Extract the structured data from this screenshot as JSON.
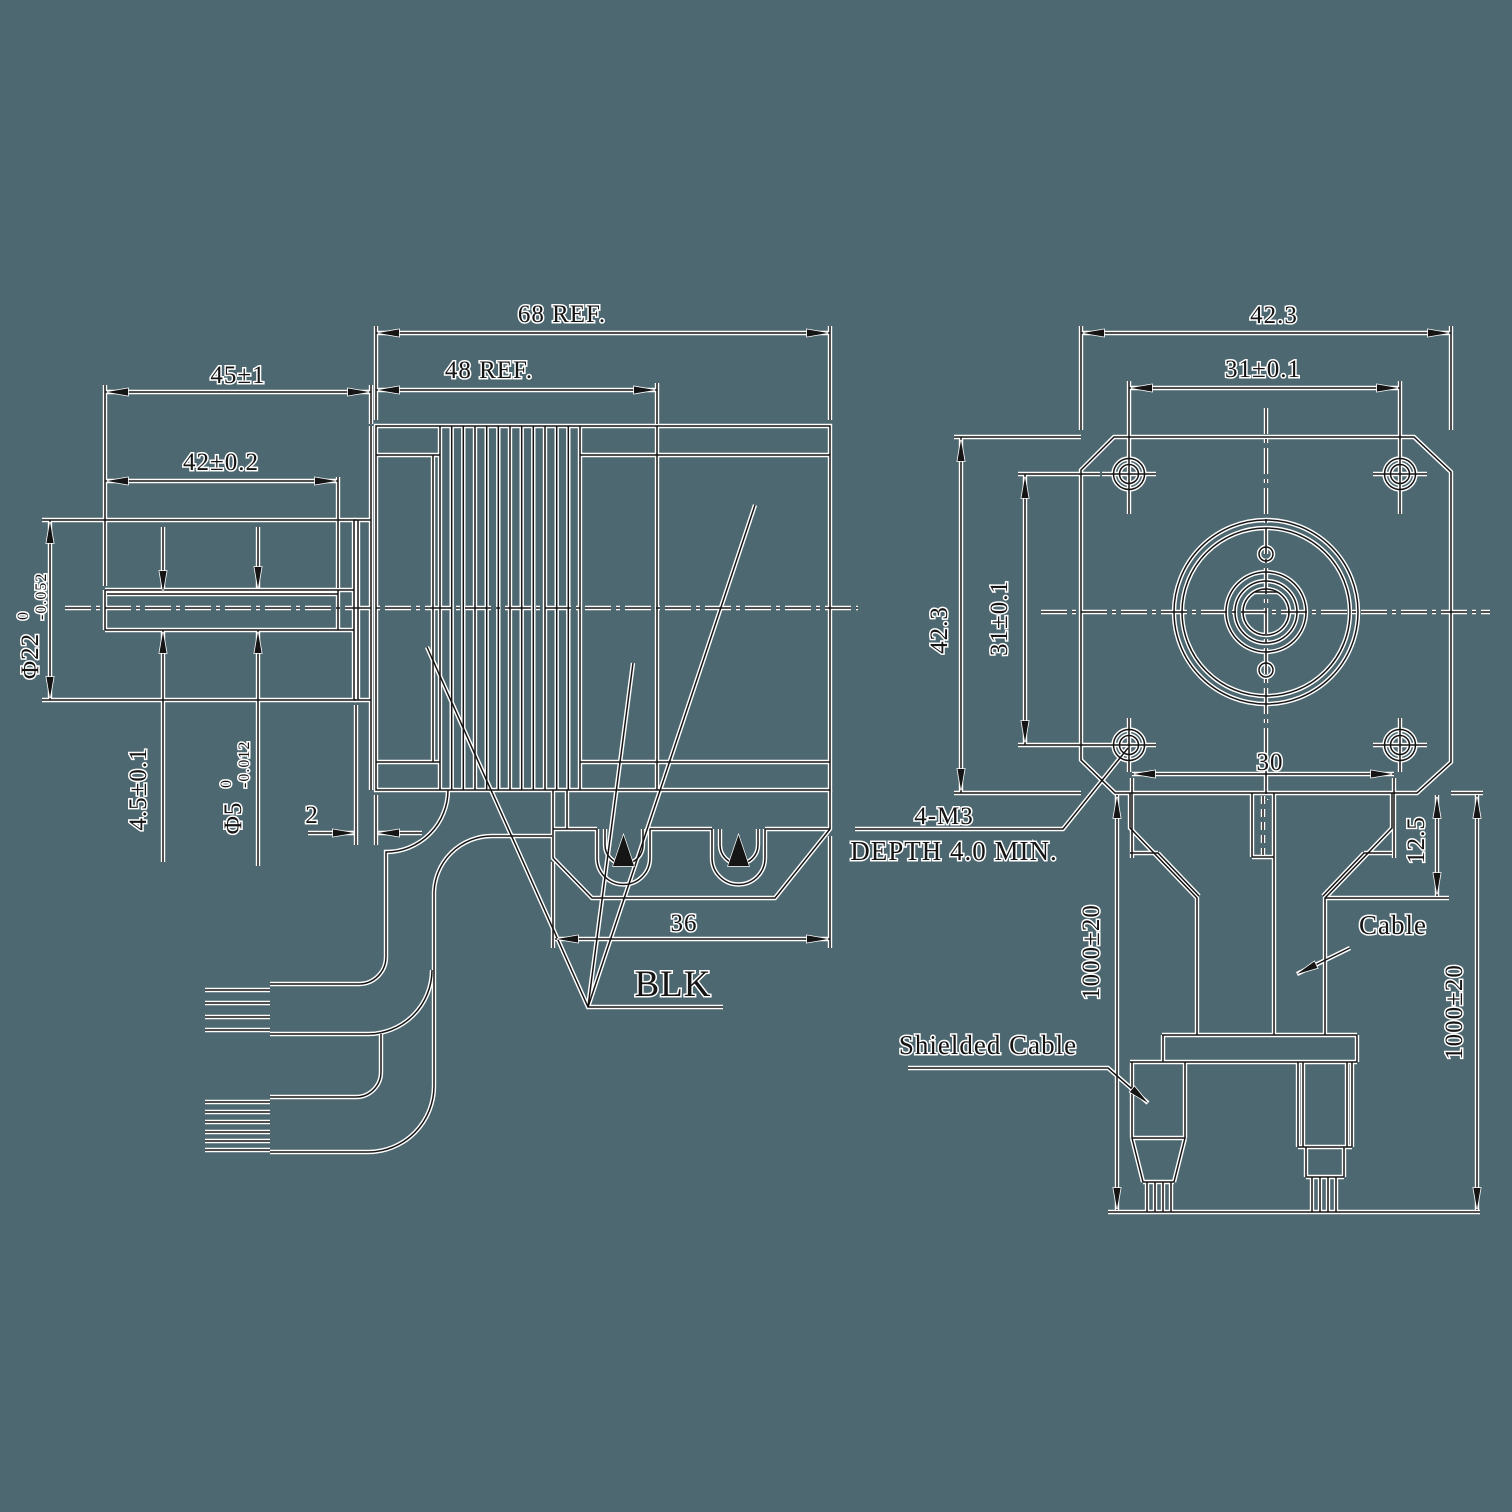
{
  "drawing": {
    "background_color": "#4d6870",
    "ink_color": "#151515",
    "halo_color": "#ffffff",
    "side_view": {
      "overall_length": "68 REF.",
      "motor_length": "48 REF.",
      "shaft_extension": "45±1",
      "shaft_flat_length": "42±0.2",
      "pilot_diameter": "Φ22",
      "pilot_tol_upper": "0",
      "pilot_tol_lower": "-0.052",
      "flat_height": "4.5±0.1",
      "shaft_diameter": "Φ5",
      "shaft_tol_upper": "0",
      "shaft_tol_lower": "-0.012",
      "pilot_depth": "2",
      "connector_width": "36",
      "color_callout": "BLK"
    },
    "front_view": {
      "frame_width": "42.3",
      "hole_spacing_horizontal": "31±0.1",
      "frame_height": "42.3",
      "hole_spacing_vertical": "31±0.1",
      "rear_width": "30",
      "rear_step_depth": "12.5",
      "thread_callout_line1": "4-M3",
      "thread_callout_line2": "DEPTH 4.0 MIN.",
      "cable_length_left": "1000±20",
      "cable_length_right": "1000±20",
      "cable_label": "Cable",
      "shielded_cable_label": "Shielded Cable"
    }
  }
}
